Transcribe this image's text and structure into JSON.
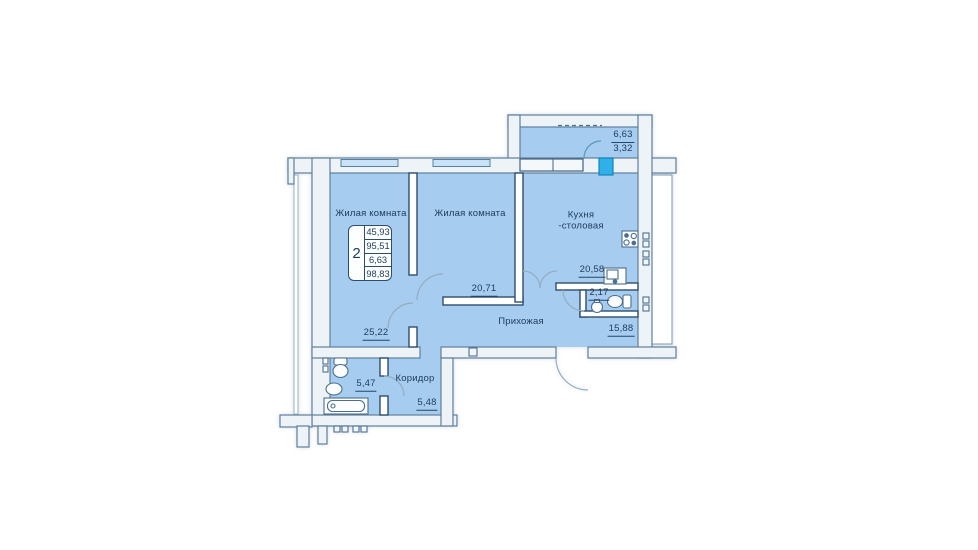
{
  "plan": {
    "rooms": [
      {
        "id": "living1",
        "label": "Жилая комната",
        "area": "25,22"
      },
      {
        "id": "living2",
        "label": "Жилая комната",
        "area": "20,71"
      },
      {
        "id": "kitchen",
        "label": "Кухня",
        "label2": "-столовая",
        "area": "20,58"
      },
      {
        "id": "hall",
        "label": "Прихожая",
        "area": "15,88"
      },
      {
        "id": "wc",
        "area": "2,17"
      },
      {
        "id": "bathroom",
        "area": "5,47"
      },
      {
        "id": "corridor",
        "label": "Коридор",
        "area": "5,48"
      }
    ],
    "balcony": {
      "area_full": "6,63",
      "area_counted": "3,32"
    },
    "summary": {
      "rooms_count": "2",
      "living_area": "45,93",
      "apartment_area": "95,51",
      "balcony_area": "6,63",
      "total_area": "98,83"
    },
    "colors": {
      "room_fill": "#a6ccef",
      "wall_fill": "#eef3f7",
      "wall_stroke": "#60809c",
      "partition_stroke": "#2e4e6e",
      "glass": "#c9e2f5",
      "balcony_door": "#2fb0e8",
      "text": "#1d3b5b"
    }
  }
}
